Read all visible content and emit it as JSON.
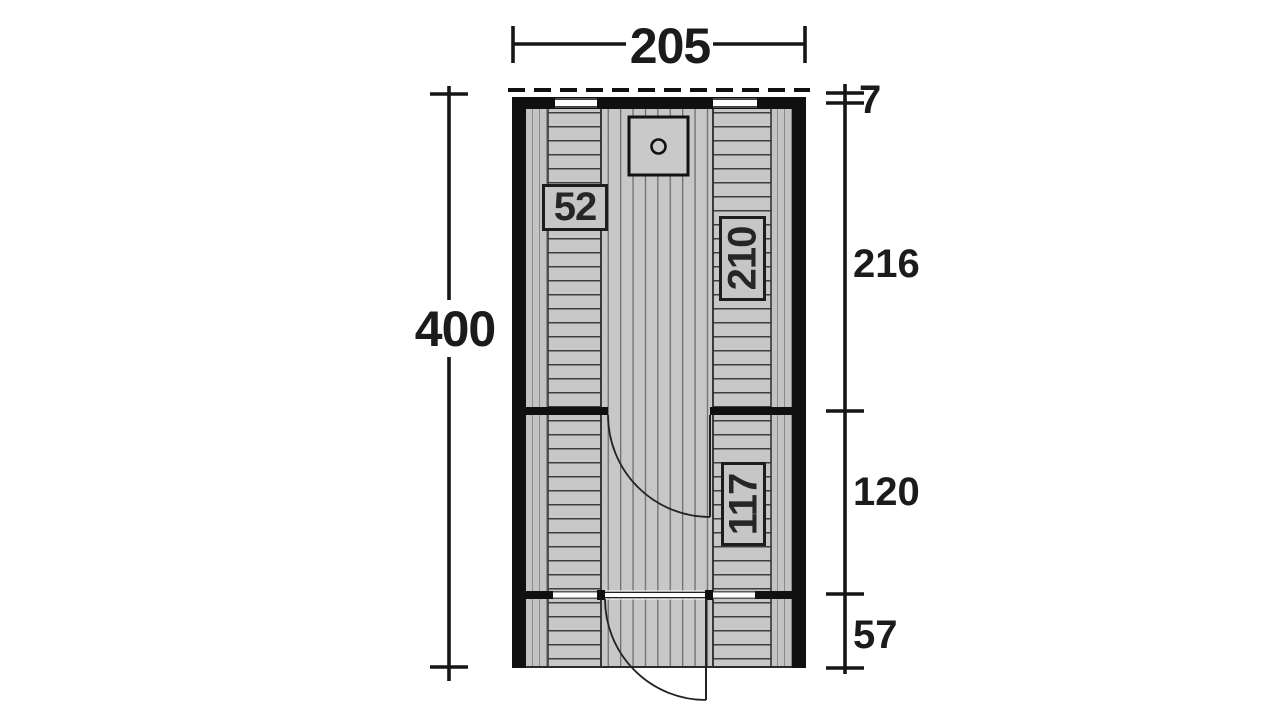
{
  "diagram": {
    "type": "floor-plan-top-view",
    "overall_dimensions": {
      "width_label": "205",
      "height_label": "400"
    },
    "right_dimension_chain": [
      {
        "label": "7",
        "meaning": "roof-overhang-depth"
      },
      {
        "label": "216",
        "meaning": "rear-room-depth"
      },
      {
        "label": "120",
        "meaning": "middle-room-depth"
      },
      {
        "label": "57",
        "meaning": "front-porch-depth"
      }
    ],
    "room_labels": [
      {
        "label": "52",
        "orientation": "horizontal"
      },
      {
        "label": "210",
        "orientation": "vertical"
      },
      {
        "label": "117",
        "orientation": "vertical"
      }
    ],
    "icons": [
      {
        "name": "stove-icon",
        "shape": "square-with-circle"
      },
      {
        "name": "door-swing-arc",
        "count": 2
      },
      {
        "name": "roof-overhang-dashed-line",
        "style": "dashed"
      }
    ],
    "colors": {
      "wall": "#101010",
      "floor": "#c7c7c7",
      "slat_line": "#3f3f3f",
      "plank_line": "#6e6e6e",
      "dimension_line": "#161616",
      "background": "#ffffff"
    }
  }
}
